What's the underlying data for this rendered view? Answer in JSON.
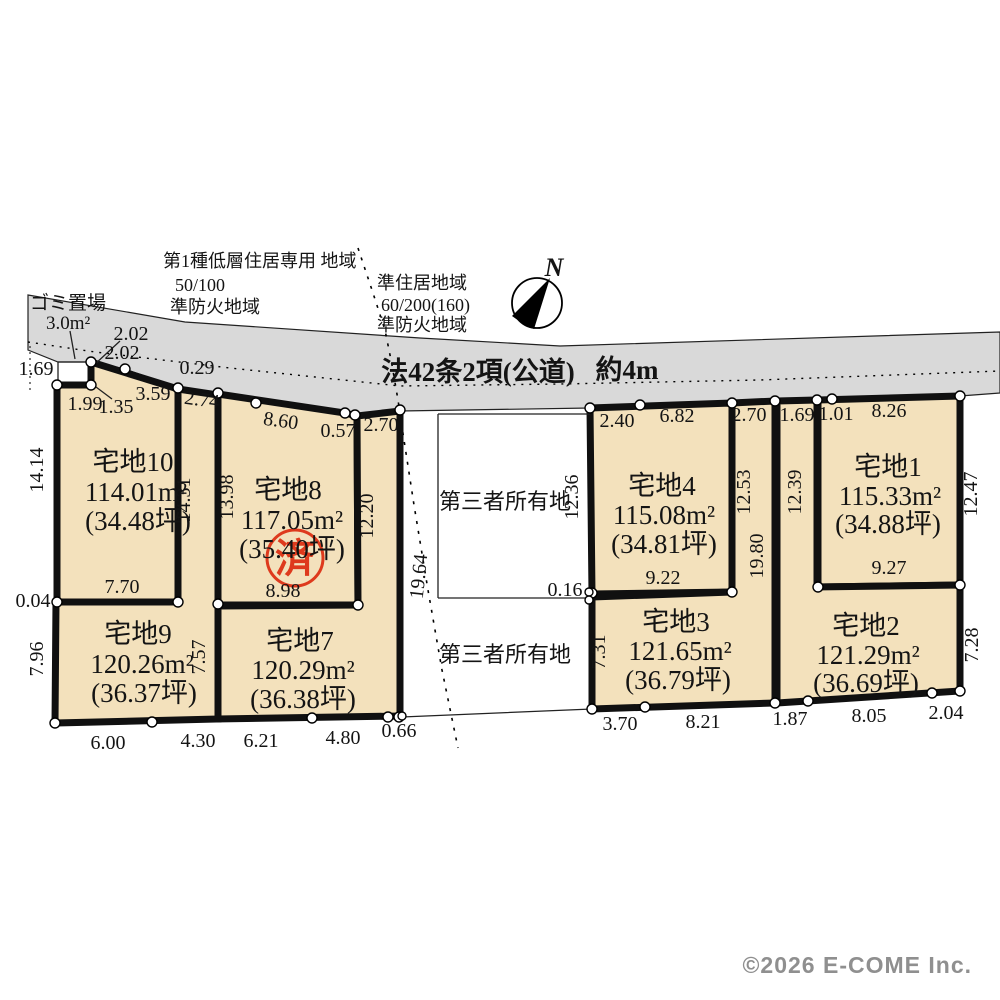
{
  "zoning_left": {
    "line1": "第1種低層住居専用 地域",
    "line2": "50/100",
    "line3": "準防火地域"
  },
  "zoning_right": {
    "line1": "準住居地域",
    "line2": "60/200(160)",
    "line3": "準防火地域"
  },
  "garbage": {
    "label": "ゴミ置場",
    "area": "3.0m²"
  },
  "compass": {
    "north": "N"
  },
  "road": {
    "label": "法42条2項(公道)",
    "width_note": "約4m"
  },
  "third_party": {
    "upper": "第三者所有地",
    "lower": "第三者所有地"
  },
  "stamp": {
    "label": "済"
  },
  "copyright": "©2026 E-COME Inc.",
  "plots": {
    "p1": {
      "name": "宅地1",
      "area": "115.33m²",
      "tsubo": "(34.88坪)"
    },
    "p2": {
      "name": "宅地2",
      "area": "121.29m²",
      "tsubo": "(36.69坪)"
    },
    "p3": {
      "name": "宅地3",
      "area": "121.65m²",
      "tsubo": "(36.79坪)"
    },
    "p4": {
      "name": "宅地4",
      "area": "115.08m²",
      "tsubo": "(34.81坪)"
    },
    "p7": {
      "name": "宅地7",
      "area": "120.29m²",
      "tsubo": "(36.38坪)"
    },
    "p8": {
      "name": "宅地8",
      "area": "117.05m²",
      "tsubo": "(35.40坪)"
    },
    "p9": {
      "name": "宅地9",
      "area": "120.26m²",
      "tsubo": "(36.37坪)"
    },
    "p10": {
      "name": "宅地10",
      "area": "114.01m²",
      "tsubo": "(34.48坪)"
    }
  },
  "dims": [
    "2.02",
    "2.02",
    "1.69",
    "1.99",
    "1.35",
    "3.59",
    "0.29",
    "2.74",
    "8.60",
    "0.57",
    "2.70",
    "14.14",
    "14.31",
    "13.98",
    "12.20",
    "19.64",
    "7.70",
    "0.04",
    "8.98",
    "7.96",
    "7.57",
    "6.00",
    "4.30",
    "6.21",
    "4.80",
    "0.66",
    "2.40",
    "6.82",
    "2.70",
    "1.69",
    "1.01",
    "8.26",
    "12.36",
    "0.16",
    "9.22",
    "12.53",
    "12.39",
    "12.47",
    "19.80",
    "9.27",
    "7.31",
    "3.70",
    "8.21",
    "1.87",
    "8.05",
    "2.04",
    "7.28"
  ]
}
